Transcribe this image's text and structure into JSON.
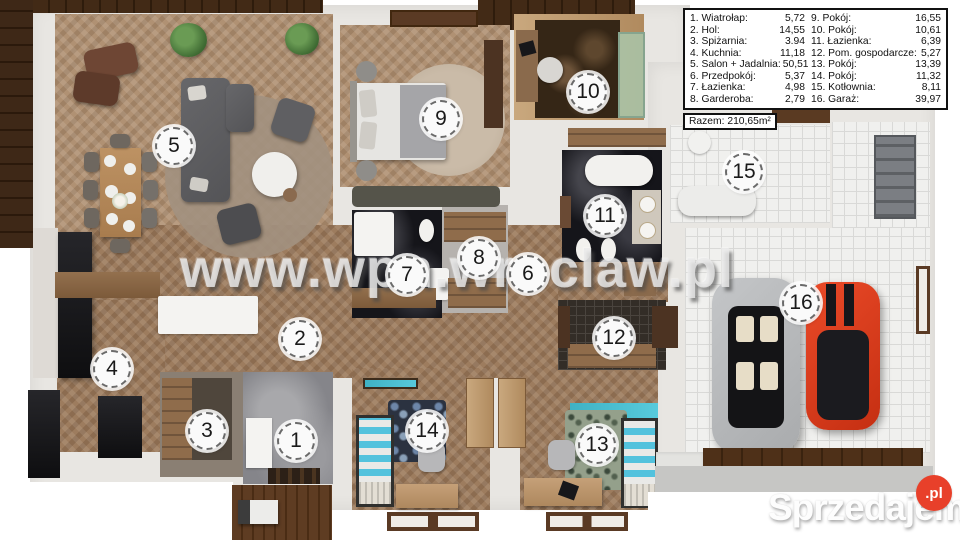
{
  "legend": {
    "columns": [
      [
        {
          "label": "1. Wiatrołap:",
          "value": "5,72"
        },
        {
          "label": "2. Hol:",
          "value": "14,55"
        },
        {
          "label": "3. Spiżarnia:",
          "value": "3.94"
        },
        {
          "label": "4. Kuchnia:",
          "value": "11,18"
        },
        {
          "label": "5. Salon + Jadalnia:",
          "value": "50,51"
        },
        {
          "label": "6. Przedpokój:",
          "value": "5,37"
        },
        {
          "label": "7. Łazienka:",
          "value": "4,98"
        },
        {
          "label": "8. Garderoba:",
          "value": "2,79"
        }
      ],
      [
        {
          "label": "9. Pokój:",
          "value": "16,55"
        },
        {
          "label": "10. Pokój:",
          "value": "10,61"
        },
        {
          "label": "11. Łazienka:",
          "value": "6,39"
        },
        {
          "label": "12. Pom. gospodarcze:",
          "value": "5,27"
        },
        {
          "label": "13. Pokój:",
          "value": "13,39"
        },
        {
          "label": "14. Pokój:",
          "value": "11,32"
        },
        {
          "label": "15. Kotłownia:",
          "value": "8,11"
        },
        {
          "label": "16. Garaż:",
          "value": "39,97"
        }
      ]
    ],
    "total": "Razem: 210,65m²"
  },
  "watermark": "www.wpn.wroclaw.pl",
  "brand": {
    "name": "Sprzedajemy",
    "tld": ".pl"
  },
  "colors": {
    "accent_red": "#e8402a",
    "floor_wood": "#b09173",
    "wall": "#e8e6e2"
  },
  "markers": [
    {
      "n": "1",
      "x": 296,
      "y": 441
    },
    {
      "n": "2",
      "x": 300,
      "y": 339
    },
    {
      "n": "3",
      "x": 207,
      "y": 431
    },
    {
      "n": "4",
      "x": 112,
      "y": 369
    },
    {
      "n": "5",
      "x": 174,
      "y": 146
    },
    {
      "n": "6",
      "x": 528,
      "y": 274
    },
    {
      "n": "7",
      "x": 407,
      "y": 275
    },
    {
      "n": "8",
      "x": 479,
      "y": 258
    },
    {
      "n": "9",
      "x": 441,
      "y": 119
    },
    {
      "n": "10",
      "x": 588,
      "y": 92
    },
    {
      "n": "11",
      "x": 605,
      "y": 216
    },
    {
      "n": "12",
      "x": 614,
      "y": 338
    },
    {
      "n": "13",
      "x": 597,
      "y": 445
    },
    {
      "n": "14",
      "x": 427,
      "y": 431
    },
    {
      "n": "15",
      "x": 744,
      "y": 172
    },
    {
      "n": "16",
      "x": 801,
      "y": 303
    }
  ]
}
